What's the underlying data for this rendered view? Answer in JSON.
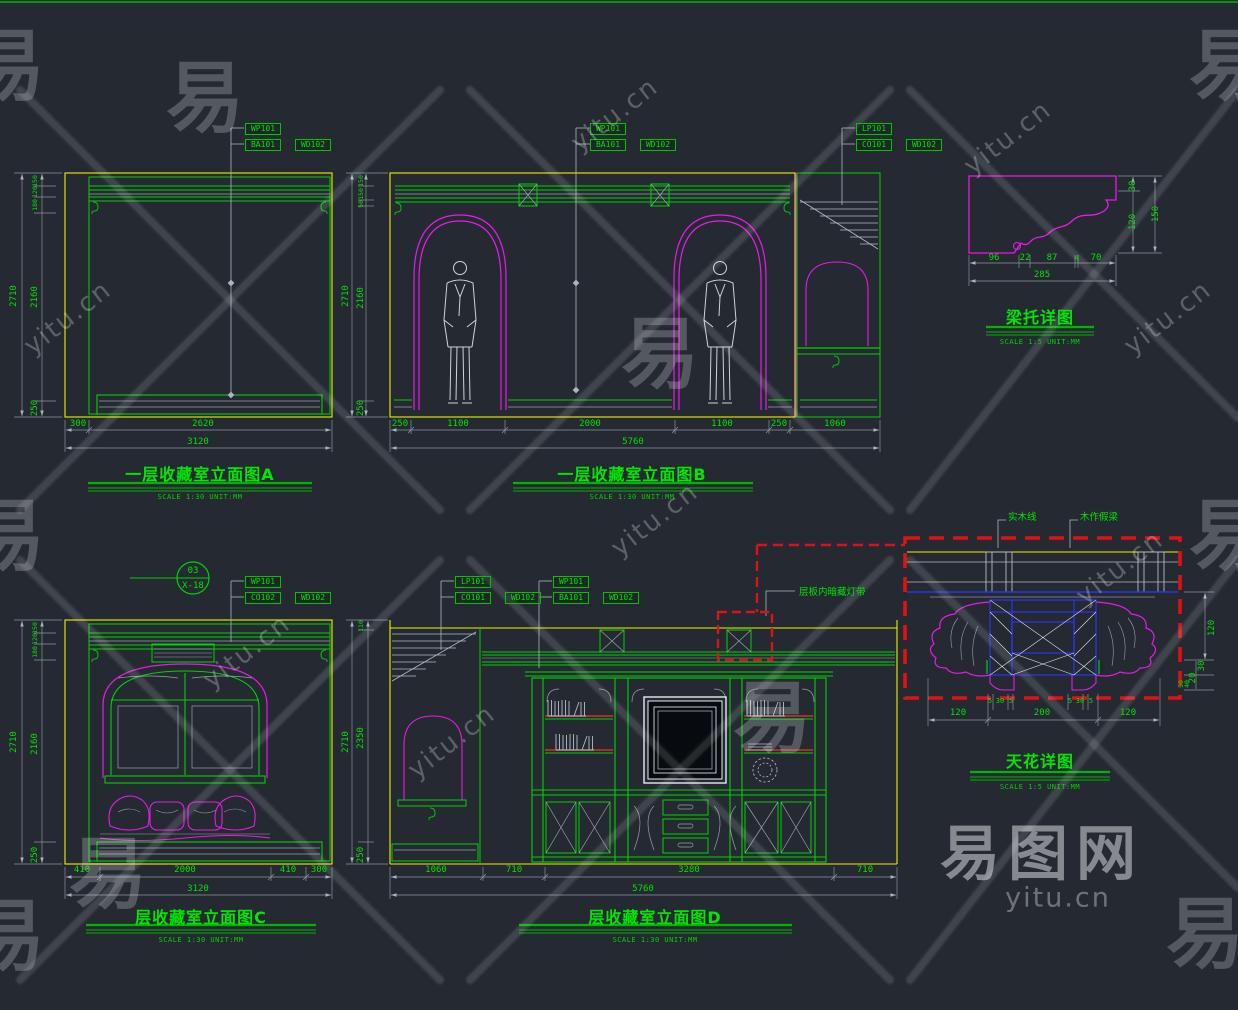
{
  "colors": {
    "bg": "#242932",
    "green": "#00e400",
    "yellow": "#f0f000",
    "magenta": "#e81ae8",
    "red": "#df1212",
    "blue": "#2a35e8",
    "gray": "#aeb4be",
    "shelf_red": "#d23326"
  },
  "wm": {
    "logo": "易图网",
    "site": "yitu.cn",
    "glyph": "易"
  },
  "elevA": {
    "title": "一层收藏室立面图A",
    "scale_note": "SCALE 1:30  UNIT:MM",
    "tags": [
      "WP101",
      "BA101",
      "WD102"
    ],
    "dims": {
      "left_outer": "2710",
      "left": [
        "150",
        "120",
        "180",
        "2160",
        "250"
      ],
      "bottom": [
        "300",
        "2620"
      ],
      "bottom_total": "3120"
    }
  },
  "elevB": {
    "title": "一层收藏室立面图B",
    "scale_note": "SCALE 1:30  UNIT:MM",
    "tags_mid": [
      "WP101",
      "BA101",
      "WD102"
    ],
    "tags_right": [
      "LP101",
      "CO101",
      "WD102"
    ],
    "dims": {
      "left_outer": "2710",
      "left": [
        "150",
        "150",
        "50",
        "2160",
        "250"
      ],
      "bottom": [
        "250",
        "1100",
        "2000",
        "1100",
        "250",
        "1060"
      ],
      "bottom_total": "5760"
    }
  },
  "corbel": {
    "title": "梁托详图",
    "scale_note": "SCALE 1:5  UNIT:MM",
    "dims": {
      "bottom": [
        "96",
        "22",
        "87",
        "4",
        "70"
      ],
      "bottom_total": "285",
      "right": [
        "30",
        "120"
      ],
      "right_outer": "150"
    }
  },
  "elevC": {
    "title": "层收藏室立面图C",
    "scale_note": "SCALE 1:30  UNIT:MM",
    "callout": {
      "top": "03",
      "bottom": "X-18"
    },
    "tags": [
      "WP101",
      "CO102",
      "WD102"
    ],
    "dims": {
      "left_outer": "2710",
      "left": [
        "150",
        "120",
        "180",
        "2160",
        "250"
      ],
      "bottom": [
        "410",
        "2000",
        "410",
        "300"
      ],
      "bottom_total": "3120"
    }
  },
  "elevD": {
    "title": "层收藏室立面图D",
    "scale_note": "SCALE 1:30  UNIT:MM",
    "tags_left": [
      "LP101",
      "CO101",
      "WD102"
    ],
    "tags_mid": [
      "WP101",
      "BA101",
      "WD102"
    ],
    "note": "层板内暗藏灯带",
    "dims": {
      "left_outer": "2710",
      "left": [
        "110",
        "2350",
        "250"
      ],
      "bottom": [
        "1060",
        "710",
        "3280",
        "710"
      ],
      "bottom_total": "5760"
    }
  },
  "ceiling": {
    "title": "天花详图",
    "scale_note": "SCALE 1:5  UNIT:MM",
    "labels": [
      "实木线",
      "木作假梁"
    ],
    "dims": {
      "small_left": [
        "5",
        "30",
        "5"
      ],
      "small_right": [
        "5",
        "30",
        "5"
      ],
      "bottom": [
        "120",
        "200",
        "120"
      ],
      "right": [
        "120",
        "30",
        "20"
      ],
      "right_small": [
        "50",
        "40"
      ]
    }
  }
}
